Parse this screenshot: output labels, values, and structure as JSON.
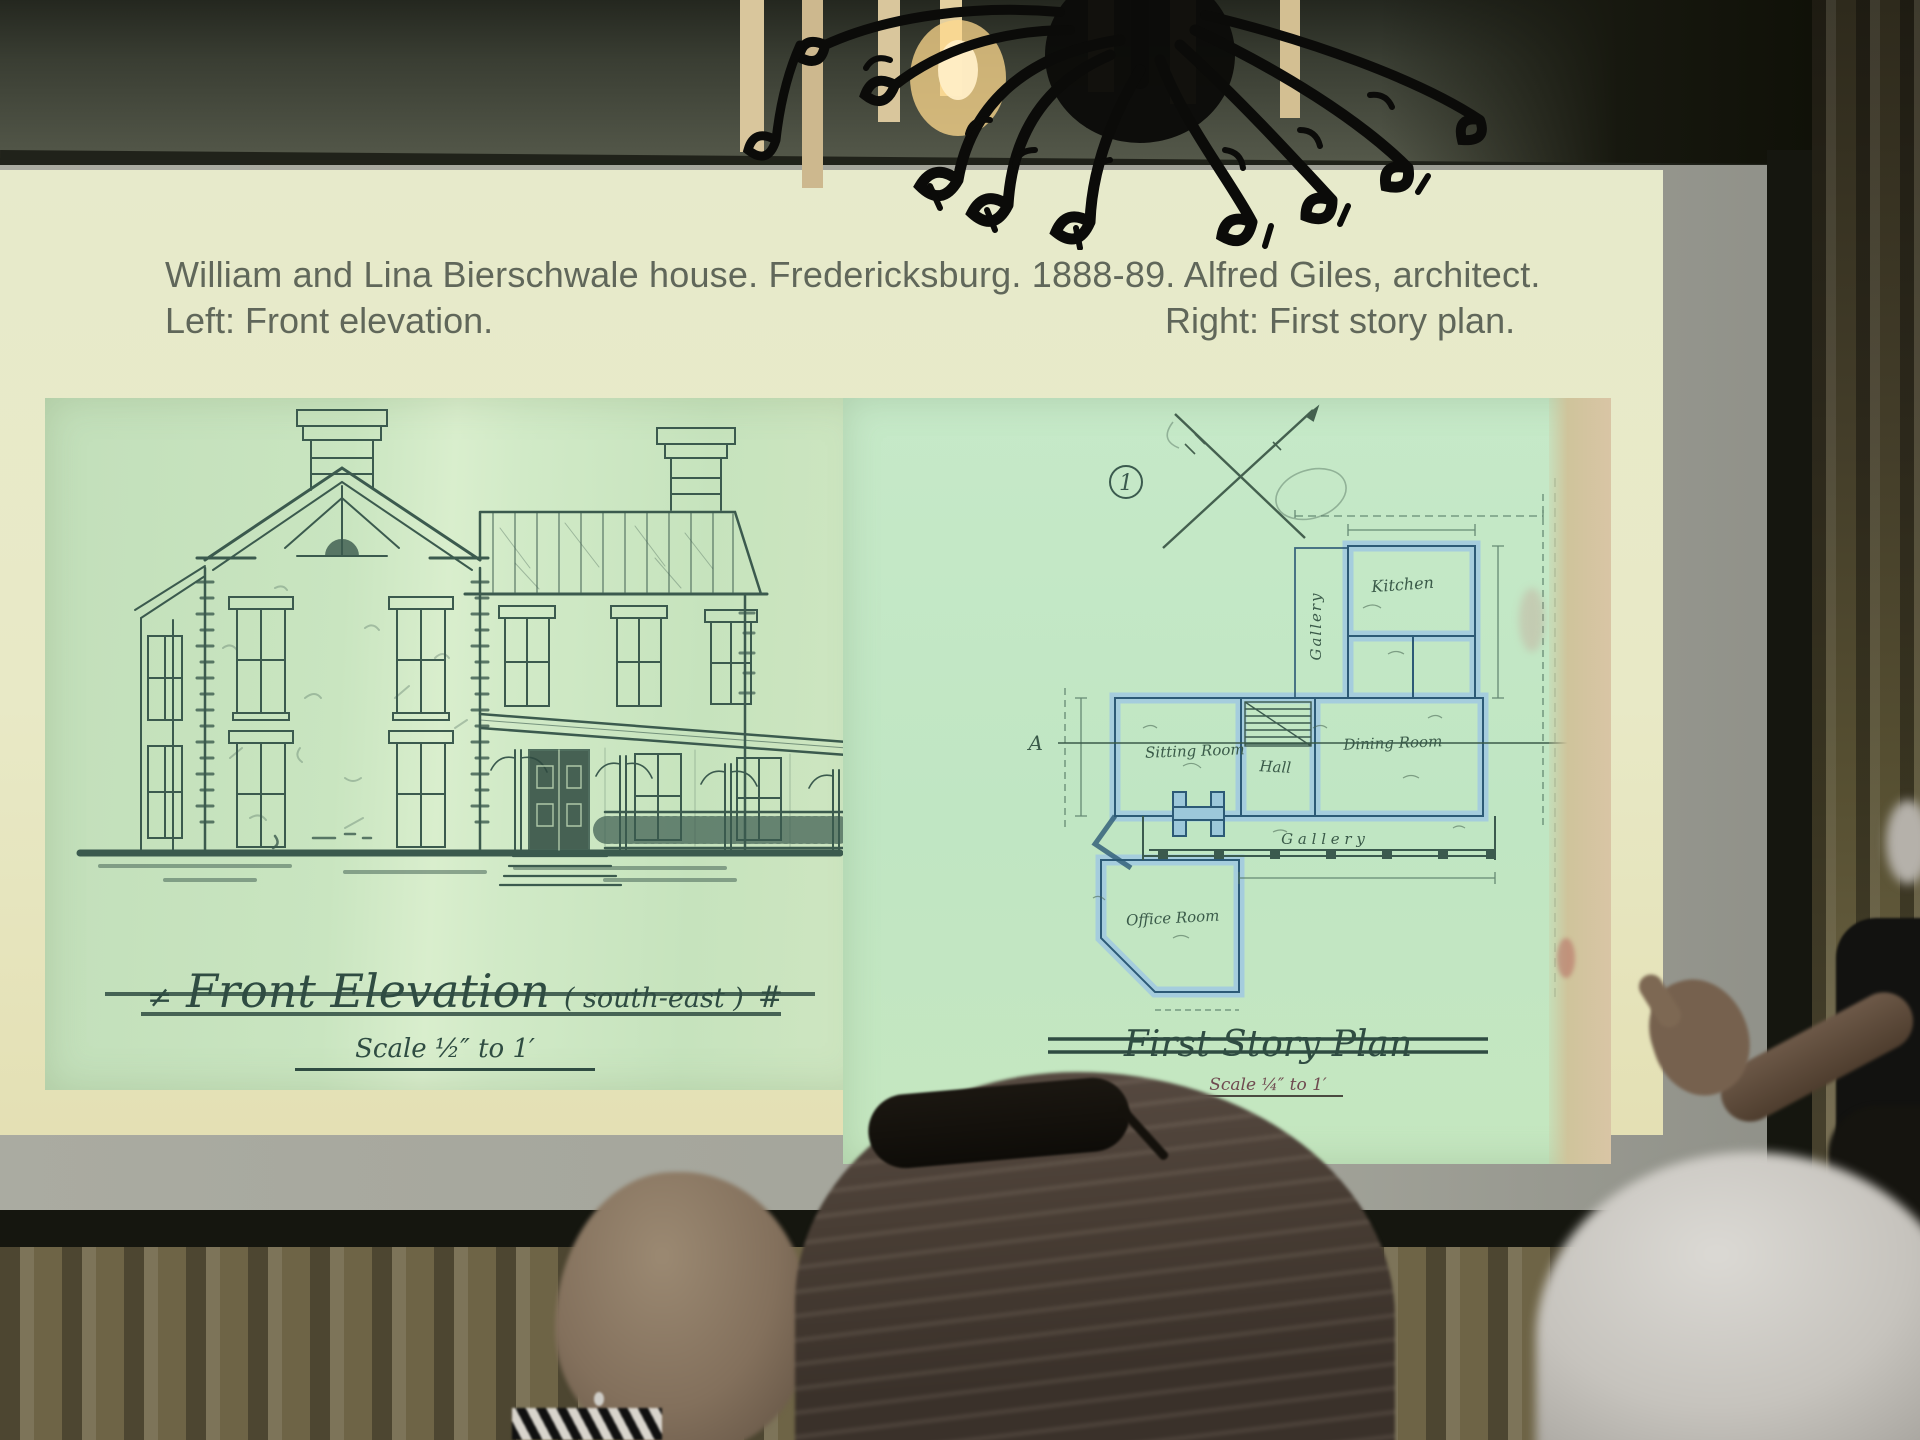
{
  "slide": {
    "title": "William and Lina Bierschwale house. Fredericksburg. 1888-89. Alfred Giles, architect.",
    "subtitle_left": "Left: Front elevation.",
    "subtitle_right": "Right: First story plan.",
    "elevation_figure": {
      "caption": "Front Elevation",
      "caption_paren": "( south-east )",
      "caption_mark": "#",
      "scale_note": "Scale ½″ to 1′"
    },
    "plan_figure": {
      "sheet_number": "1",
      "caption": "First Story Plan",
      "scale_note": "Scale ¼″ to 1′",
      "marker_left": "A",
      "marker_right": "B",
      "rooms": {
        "gallery_side": "Gallery",
        "kitchen": "Kitchen",
        "sitting_room": "Sitting Room",
        "hall": "Hall",
        "dining_room": "Dining Room",
        "office_room": "Office Room",
        "gallery_front": "G a l l e r y"
      }
    }
  },
  "colors": {
    "slide_bg": "#e7eacb",
    "paper_green": "#c8e6c1",
    "plan_wall_fill": "#a5cddd",
    "plan_wall_edge": "#2c5a76",
    "ink": "#3b5a4e",
    "curtain": "#6e6446",
    "screen_gray": "#a2a399"
  }
}
